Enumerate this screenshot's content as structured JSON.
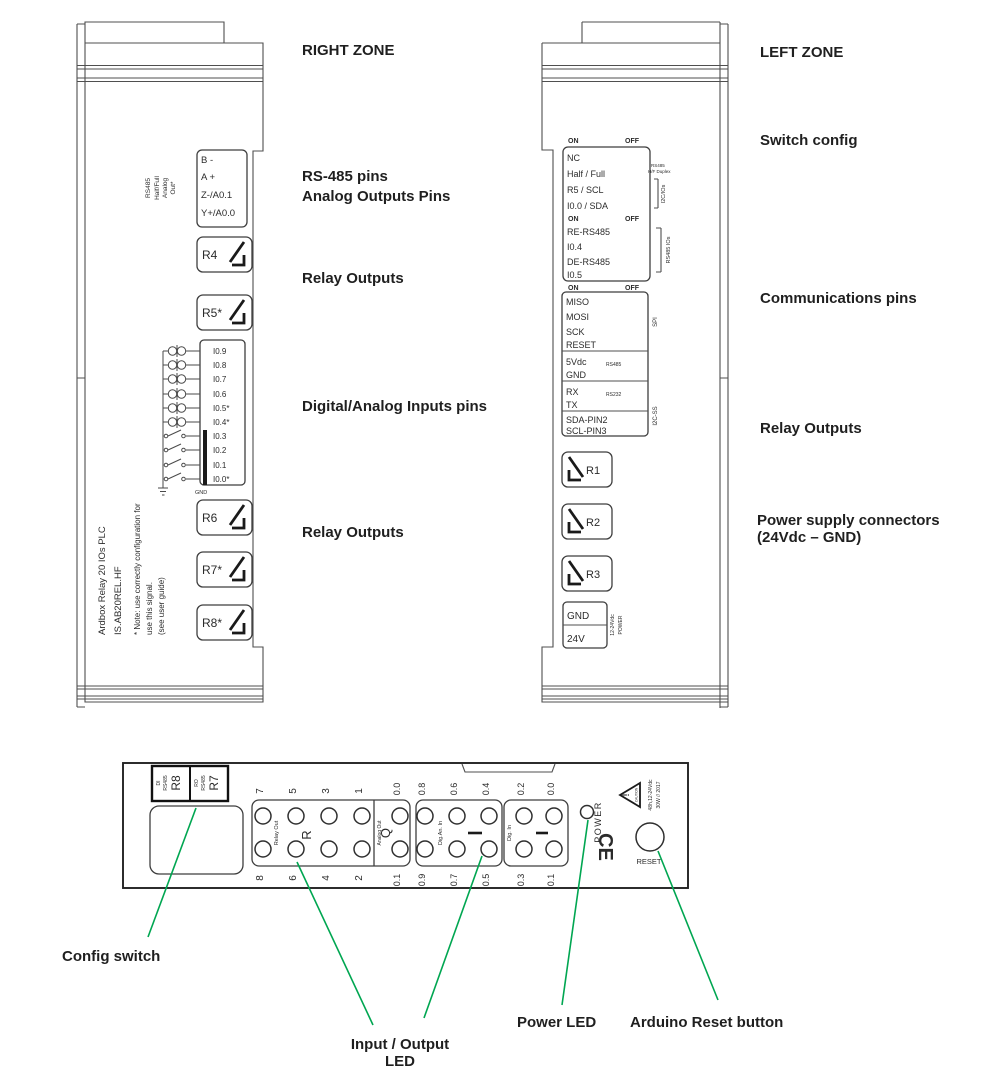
{
  "colors": {
    "annotation_green": "#00A651",
    "ink": "#3e3e3e",
    "label_text": "#1f1f1f"
  },
  "annotations": {
    "right_zone": "RIGHT ZONE",
    "rs485_pins": "RS-485 pins",
    "analog_outputs_pins": "Analog Outputs Pins",
    "relay_outputs_right_top": "Relay Outputs",
    "digital_analog_inputs": "Digital/Analog Inputs pins",
    "relay_outputs_right_bottom": "Relay Outputs",
    "left_zone": "LEFT ZONE",
    "switch_config": "Switch config",
    "communications_pins": "Communications pins",
    "relay_outputs_left": "Relay Outputs",
    "power_supply_line1": "Power supply connectors",
    "power_supply_line2": "(24Vdc – GND)",
    "config_switch": "Config switch",
    "io_led_line1": "Input / Output",
    "io_led_line2": "LED",
    "power_led": "Power LED",
    "arduino_reset": "Arduino Reset button"
  },
  "right_device": {
    "header_vertical": [
      "RS485",
      "Half/Full",
      "Analog",
      "Out*"
    ],
    "connector_pins": [
      "B -",
      "A +",
      "Z-/A0.1",
      "Y+/A0.0"
    ],
    "relays_top": [
      "R4",
      "R5*"
    ],
    "inputs": [
      "I0.9",
      "I0.8",
      "I0.7",
      "I0.6",
      "I0.5*",
      "I0.4*",
      "I0.3",
      "I0.2",
      "I0.1",
      "I0.0*"
    ],
    "gnd": "GND",
    "relays_bottom": [
      "R6",
      "R7*",
      "R8*"
    ],
    "side_lines": [
      "Ardbox Relay 20 IOs PLC",
      "IS.AB20REL.HF",
      "* Note: use correctly configuration for",
      "use this signal.",
      "(see user guide)"
    ]
  },
  "left_device": {
    "on": "ON",
    "off": "OFF",
    "dip_rows_1": [
      "NC",
      "Half / Full",
      "R5 / SCL",
      "I0.0 / SDA"
    ],
    "dip_rows_2": [
      "RE-RS485",
      "I0.4",
      "DE-RS485",
      "I0.5"
    ],
    "tag_rs485_hf_1": "RS485",
    "tag_rs485_hf_2": "H/F Duplex",
    "tag_i2c_ios": "I2C/IOs",
    "tag_rs485_ios": "RS485 IOs",
    "spi_pins": [
      "MISO",
      "MOSI",
      "SCK",
      "RESET"
    ],
    "pins_5v": [
      "5Vdc",
      "GND"
    ],
    "tag_rs485": "RS485",
    "pins_serial": [
      "RX",
      "TX"
    ],
    "tag_rs232": "RS232",
    "pins_i2c": [
      "SDA-PIN2",
      "SCL-PIN3"
    ],
    "tag_spi": "SPI",
    "tag_i2c_ss": "I2C-SS",
    "relays": [
      "R1",
      "R2",
      "R3"
    ],
    "power_pins": [
      "GND",
      "24V"
    ],
    "tag_power_1": "12-24Vdc",
    "tag_power_2": "POWER"
  },
  "bottom_panel": {
    "label_di": "DI",
    "label_di_bus": "RS485",
    "label_r8": "R8",
    "label_ro": "RO",
    "label_ro_bus": "RS485",
    "label_r7": "R7",
    "relay_out": "Relay Out",
    "relay_letter": "R",
    "relay_nums_top": [
      "7",
      "5",
      "3",
      "1"
    ],
    "relay_nums_bottom": [
      "8",
      "6",
      "4",
      "2"
    ],
    "analog_out": "Analog Out",
    "analog_letter": "Q",
    "analog_num_top": "0.0",
    "analog_num_bottom": "0.1",
    "digan_label": "Dig.An. In",
    "digan_top": [
      "0.8",
      "0.6",
      "0.4"
    ],
    "digan_bottom": [
      "0.9",
      "0.7",
      "0.5"
    ],
    "dig_label": "Dig. In",
    "dig_top": [
      "0.2",
      "0.0"
    ],
    "dig_bottom": [
      "0.3",
      "0.1"
    ],
    "power": "POWER",
    "ce": "CE",
    "caution_word": "CAUTION",
    "caution_line1": "48h,12-24Vdc",
    "caution_line2": "30W // 2017",
    "reset": "RESET"
  }
}
